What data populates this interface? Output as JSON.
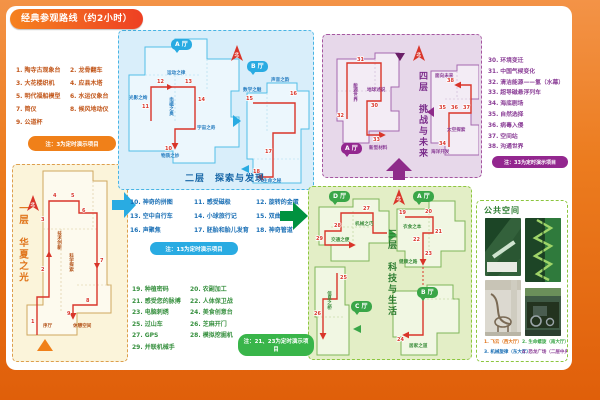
{
  "header": {
    "title": "经典参观路线（约2小时）"
  },
  "compass": "北",
  "floor1": {
    "title": "一层　华夏之光",
    "items": [
      "1. 陶寺古观象台",
      "2. 龙骨翻车",
      "3. 大花楼织机",
      "4. 应县木塔",
      "5. 明代福船模型",
      "6. 水运仪象台",
      "7. 简仪",
      "8. 候风地动仪",
      "9. 公道杯"
    ],
    "note": "注：3为定时演示项目",
    "areas": [
      "序厅",
      "技术创新",
      "科学探索",
      "休憩空间"
    ],
    "stops": [
      "1",
      "2",
      "3",
      "4",
      "5",
      "6",
      "7",
      "8",
      "9"
    ]
  },
  "floor2": {
    "title": "二层　探索与发现",
    "halls": [
      "A 厅",
      "B 厅"
    ],
    "items": [
      "10. 神奇的拼图",
      "11. 感受磁极",
      "12. 旋转的金蛋",
      "13. 空中自行车",
      "14. 小球旅行记",
      "15. 双曲隧道",
      "16. 声聚焦",
      "17. 胚胎和胎儿发育",
      "18. 神奇管道"
    ],
    "note": "注：13为定时演示项目",
    "areas": [
      "光影之绚",
      "运动之律",
      "电磁之奥",
      "宇宙之奇",
      "物质之妙",
      "数学之魅",
      "声音之韵",
      "生命之秘"
    ],
    "stops": [
      "10",
      "11",
      "12",
      "13",
      "14",
      "15",
      "16",
      "17",
      "18"
    ]
  },
  "floor3": {
    "title": "三层　科技与生活",
    "halls": [
      "D 厅",
      "A 厅",
      "B 厅",
      "C 厅"
    ],
    "items": [
      "19. 种植密码",
      "20. 农副加工",
      "21. 感受您的脉搏",
      "22. 人体保卫战",
      "23. 电脑刺绣",
      "24. 美食创意台",
      "25. 过山车",
      "26. 芝麻开门",
      "27. GPS",
      "28. 模拟挖掘机",
      "29. 并联机械手"
    ],
    "note": "注：21、23为定时演示项目",
    "areas": [
      "交通之便",
      "机械之巧",
      "衣食之本",
      "健康之路",
      "信息之桥",
      "居家之道"
    ],
    "stops": [
      "19",
      "20",
      "21",
      "22",
      "23",
      "24",
      "25",
      "26",
      "27",
      "28",
      "29"
    ]
  },
  "floor4": {
    "title": "四层　挑战与未来",
    "halls": [
      "A 厅"
    ],
    "items": [
      "30. 环境变迁",
      "31. 中国气候变化",
      "32. 清洁能源——氢（水幕）",
      "33. 超导磁悬浮列车",
      "34. 海底剧场",
      "35. 自然选择",
      "36. 病毒入侵",
      "37. 空间站",
      "38. 沟通世界"
    ],
    "note": "注：33为定时演示项目",
    "areas": [
      "能源世界",
      "地球述说",
      "新型材料",
      "面向未来",
      "太空探索",
      "海洋开发"
    ],
    "stops": [
      "30",
      "31",
      "32",
      "33",
      "34",
      "35",
      "36",
      "37",
      "38"
    ]
  },
  "public_space": {
    "title": "公共空间",
    "captions": [
      "1. 飞云（西大厅）",
      "2. 生命螺旋（南大厅）",
      "3. 机械旋律（东大厅）",
      "4. 恐龙广场（二层中央大厅）"
    ]
  }
}
